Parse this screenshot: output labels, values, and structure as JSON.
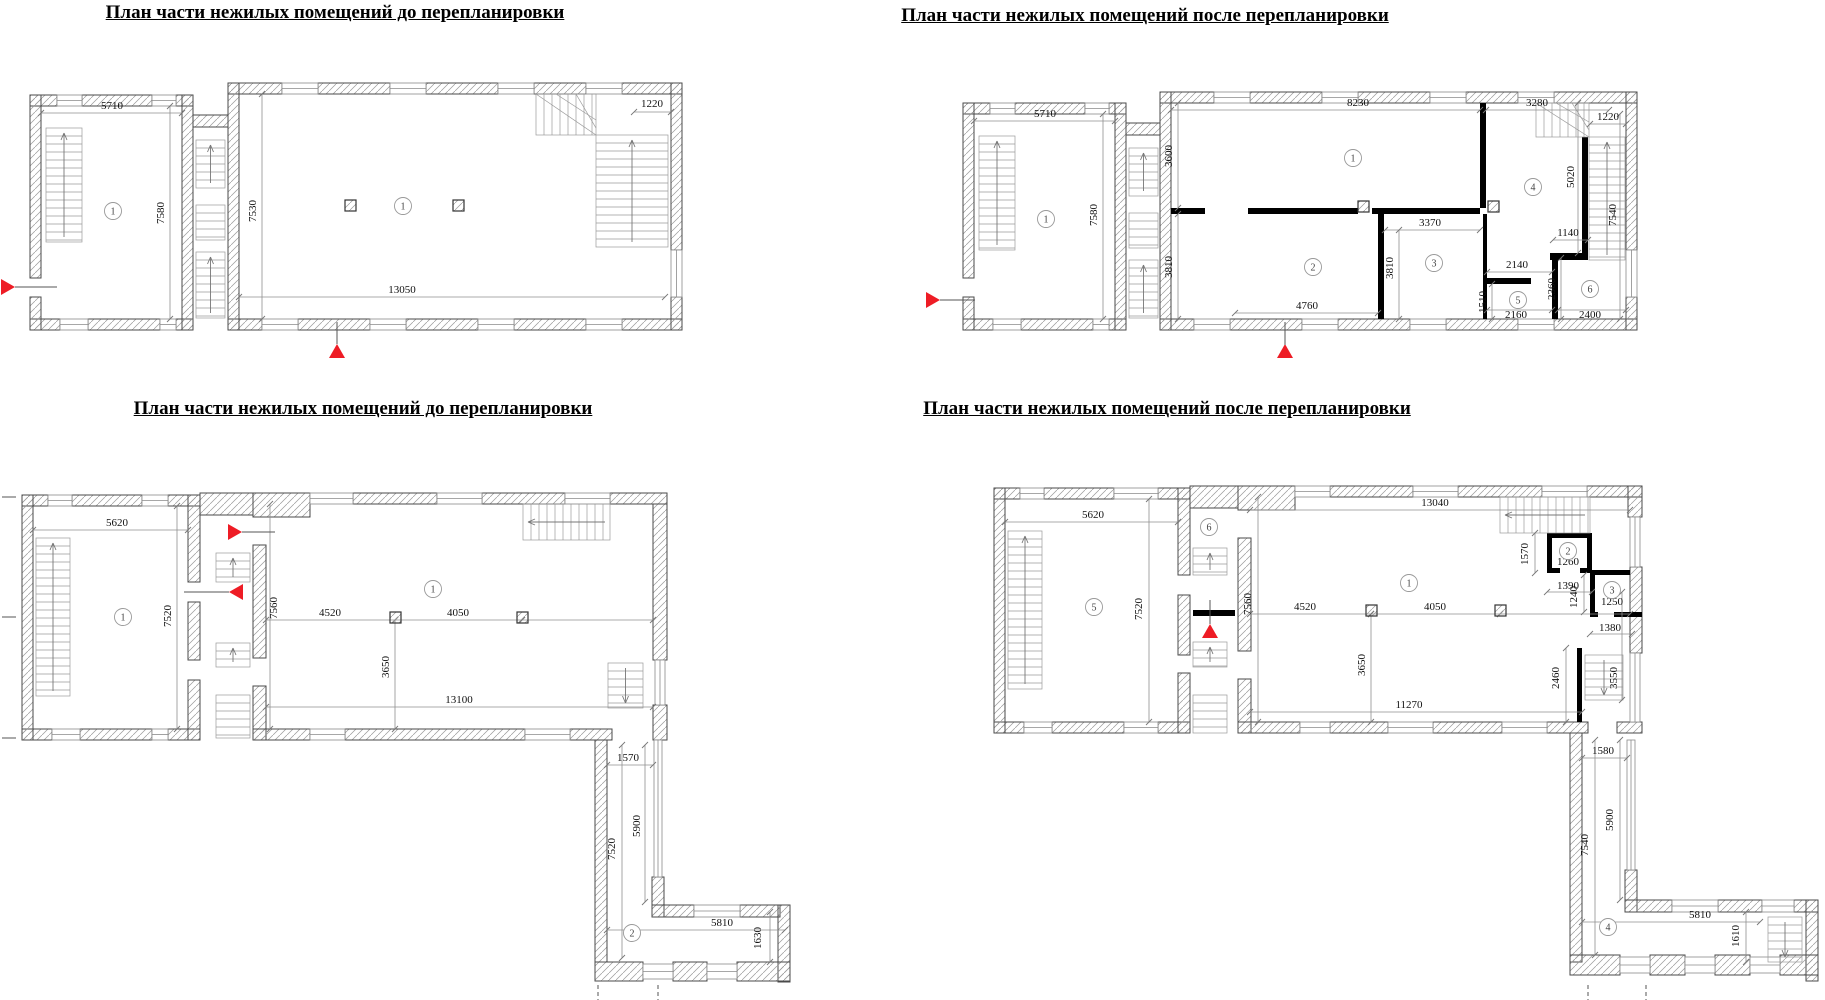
{
  "document": {
    "type": "architectural-floor-plan-sheet",
    "language": "ru"
  },
  "colors": {
    "background": "#ffffff",
    "drawing_line": "#4a4a4a",
    "hatch_line": "#9a9a9a",
    "dimension_line": "#8f8f8f",
    "new_wall": "#000000",
    "marker_red": "#ee1c25",
    "text": "#111111"
  },
  "plans": [
    {
      "id": "A",
      "name": "top-left-before",
      "title": "План части нежилых помещений  до перепланировки",
      "dims": [
        {
          "t": "5710",
          "x": 112,
          "y": 109,
          "r": 0
        },
        {
          "t": "7580",
          "x": 164,
          "y": 213,
          "r": -90
        },
        {
          "t": "7530",
          "x": 256,
          "y": 211,
          "r": -90
        },
        {
          "t": "13050",
          "x": 402,
          "y": 293,
          "r": 0
        },
        {
          "t": "1220",
          "x": 652,
          "y": 107,
          "r": 0
        }
      ],
      "rooms": [
        {
          "n": "1",
          "x": 113,
          "y": 211
        },
        {
          "n": "1",
          "x": 403,
          "y": 206
        }
      ],
      "markers": [
        {
          "dir": "right",
          "x": 8,
          "y": 287,
          "line": [
            15,
            287,
            57,
            287
          ]
        },
        {
          "dir": "up",
          "x": 337,
          "y": 351,
          "line": [
            337,
            322,
            337,
            344
          ]
        }
      ]
    },
    {
      "id": "B",
      "name": "top-right-after",
      "title": "План части нежилых помещений после перепланировки",
      "dims": [
        {
          "t": "5710",
          "x": 1045,
          "y": 117,
          "r": 0
        },
        {
          "t": "7580",
          "x": 1097,
          "y": 215,
          "r": -90
        },
        {
          "t": "8230",
          "x": 1358,
          "y": 106,
          "r": 0
        },
        {
          "t": "3280",
          "x": 1537,
          "y": 106,
          "r": 0
        },
        {
          "t": "1220",
          "x": 1608,
          "y": 120,
          "r": 0
        },
        {
          "t": "3600",
          "x": 1172,
          "y": 156,
          "r": -90
        },
        {
          "t": "3810",
          "x": 1172,
          "y": 267,
          "r": -90
        },
        {
          "t": "3370",
          "x": 1430,
          "y": 226,
          "r": 0
        },
        {
          "t": "3810",
          "x": 1393,
          "y": 268,
          "r": -90
        },
        {
          "t": "4760",
          "x": 1307,
          "y": 309,
          "r": 0
        },
        {
          "t": "2140",
          "x": 1517,
          "y": 268,
          "r": 0
        },
        {
          "t": "1510",
          "x": 1486,
          "y": 302,
          "r": -90
        },
        {
          "t": "2160",
          "x": 1516,
          "y": 318,
          "r": 0
        },
        {
          "t": "2360",
          "x": 1555,
          "y": 289,
          "r": -90
        },
        {
          "t": "2400",
          "x": 1590,
          "y": 318,
          "r": 0
        },
        {
          "t": "1140",
          "x": 1568,
          "y": 236,
          "r": 0
        },
        {
          "t": "5020",
          "x": 1574,
          "y": 177,
          "r": -90
        },
        {
          "t": "7540",
          "x": 1616,
          "y": 215,
          "r": -90
        }
      ],
      "rooms": [
        {
          "n": "1",
          "x": 1046,
          "y": 219
        },
        {
          "n": "1",
          "x": 1353,
          "y": 158
        },
        {
          "n": "2",
          "x": 1313,
          "y": 267
        },
        {
          "n": "3",
          "x": 1434,
          "y": 263
        },
        {
          "n": "4",
          "x": 1533,
          "y": 187
        },
        {
          "n": "5",
          "x": 1518,
          "y": 300
        },
        {
          "n": "6",
          "x": 1590,
          "y": 289
        }
      ],
      "markers": [
        {
          "dir": "right",
          "x": 933,
          "y": 300,
          "line": [
            940,
            300,
            975,
            300
          ]
        },
        {
          "dir": "up",
          "x": 1285,
          "y": 351,
          "line": [
            1285,
            322,
            1285,
            345
          ]
        }
      ]
    },
    {
      "id": "C",
      "name": "bottom-left-before",
      "title": "План части нежилых помещений  до перепланировки",
      "dims": [
        {
          "t": "5620",
          "x": 117,
          "y": 526,
          "r": 0
        },
        {
          "t": "7520",
          "x": 171,
          "y": 616,
          "r": -90
        },
        {
          "t": "7560",
          "x": 277,
          "y": 608,
          "r": -90
        },
        {
          "t": "4520",
          "x": 330,
          "y": 616,
          "r": 0
        },
        {
          "t": "4050",
          "x": 458,
          "y": 616,
          "r": 0
        },
        {
          "t": "3650",
          "x": 389,
          "y": 667,
          "r": -90
        },
        {
          "t": "13100",
          "x": 459,
          "y": 703,
          "r": 0
        },
        {
          "t": "1570",
          "x": 628,
          "y": 761,
          "r": 0
        },
        {
          "t": "7520",
          "x": 615,
          "y": 849,
          "r": -90
        },
        {
          "t": "5900",
          "x": 640,
          "y": 826,
          "r": -90
        },
        {
          "t": "5810",
          "x": 722,
          "y": 926,
          "r": 0
        },
        {
          "t": "1630",
          "x": 761,
          "y": 938,
          "r": -90
        }
      ],
      "rooms": [
        {
          "n": "1",
          "x": 123,
          "y": 617
        },
        {
          "n": "1",
          "x": 433,
          "y": 589
        },
        {
          "n": "2",
          "x": 632,
          "y": 933
        }
      ],
      "markers": [
        {
          "dir": "right",
          "x": 235,
          "y": 532,
          "line": [
            242,
            532,
            275,
            532
          ]
        },
        {
          "dir": "left",
          "x": 236,
          "y": 592,
          "line": [
            184,
            592,
            229,
            592
          ]
        }
      ]
    },
    {
      "id": "D",
      "name": "bottom-right-after",
      "title": "План части нежилых помещений после перепланировки",
      "dims": [
        {
          "t": "5620",
          "x": 1093,
          "y": 518,
          "r": 0
        },
        {
          "t": "7520",
          "x": 1142,
          "y": 609,
          "r": -90
        },
        {
          "t": "13040",
          "x": 1435,
          "y": 506,
          "r": 0
        },
        {
          "t": "7560",
          "x": 1251,
          "y": 604,
          "r": -90
        },
        {
          "t": "4520",
          "x": 1305,
          "y": 610,
          "r": 0
        },
        {
          "t": "4050",
          "x": 1435,
          "y": 610,
          "r": 0
        },
        {
          "t": "3650",
          "x": 1365,
          "y": 665,
          "r": -90
        },
        {
          "t": "11270",
          "x": 1409,
          "y": 708,
          "r": 0
        },
        {
          "t": "1570",
          "x": 1528,
          "y": 554,
          "r": -90
        },
        {
          "t": "1260",
          "x": 1568,
          "y": 565,
          "r": 0
        },
        {
          "t": "1390",
          "x": 1568,
          "y": 589,
          "r": 0
        },
        {
          "t": "1240",
          "x": 1577,
          "y": 597,
          "r": -90
        },
        {
          "t": "1250",
          "x": 1612,
          "y": 605,
          "r": 0
        },
        {
          "t": "1380",
          "x": 1610,
          "y": 631,
          "r": 0
        },
        {
          "t": "2460",
          "x": 1559,
          "y": 678,
          "r": -90
        },
        {
          "t": "3550",
          "x": 1617,
          "y": 678,
          "r": -90
        },
        {
          "t": "1580",
          "x": 1603,
          "y": 754,
          "r": 0
        },
        {
          "t": "7540",
          "x": 1588,
          "y": 845,
          "r": -90
        },
        {
          "t": "5900",
          "x": 1613,
          "y": 820,
          "r": -90
        },
        {
          "t": "5810",
          "x": 1700,
          "y": 918,
          "r": 0
        },
        {
          "t": "1610",
          "x": 1739,
          "y": 936,
          "r": -90
        }
      ],
      "rooms": [
        {
          "n": "5",
          "x": 1094,
          "y": 607
        },
        {
          "n": "6",
          "x": 1209,
          "y": 527
        },
        {
          "n": "1",
          "x": 1409,
          "y": 583
        },
        {
          "n": "2",
          "x": 1568,
          "y": 551
        },
        {
          "n": "3",
          "x": 1612,
          "y": 590
        },
        {
          "n": "4",
          "x": 1608,
          "y": 927
        }
      ],
      "markers": [
        {
          "dir": "up",
          "x": 1210,
          "y": 631,
          "line": [
            1210,
            600,
            1210,
            624
          ]
        }
      ]
    }
  ]
}
